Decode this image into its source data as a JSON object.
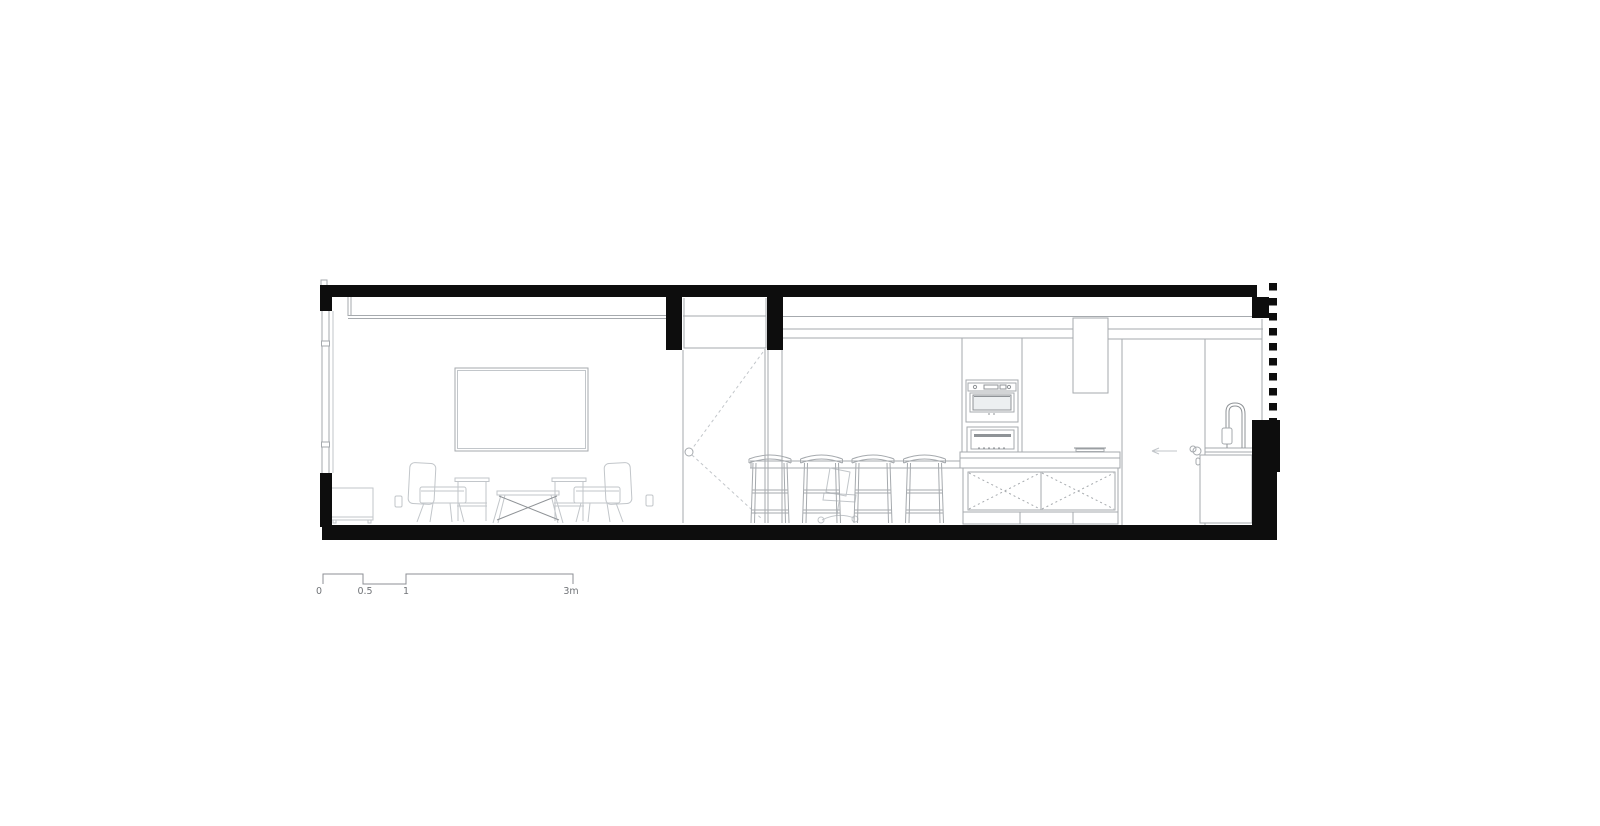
{
  "drawing": {
    "scale_unit": "m"
  },
  "scale_bar": {
    "labels": [
      "0",
      "0.5",
      "1",
      "3m"
    ]
  },
  "colors": {
    "background": "#ffffff",
    "structure": "#0d0d0d",
    "outline": "#a6aaae",
    "furniture": "#c2c6ca",
    "detail": "#8f9397",
    "text": "#717478"
  }
}
